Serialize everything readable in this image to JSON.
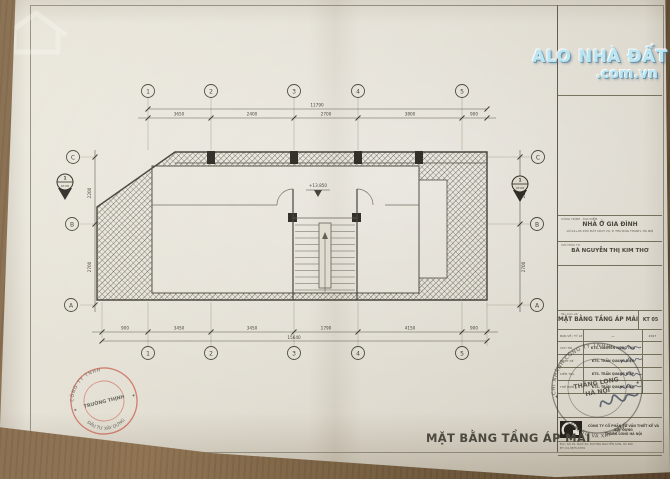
{
  "watermark": {
    "brand": "ALO NHÀ ĐẤT",
    "domain": ".com.vn"
  },
  "drawing_title": "MẶT BẰNG TẦNG ÁP MÁI",
  "colors": {
    "watermark": "#b9e4f2",
    "stamp_red": "#c43426",
    "paper": "#e9e6dc"
  },
  "plan": {
    "level": "+13.850",
    "grid_top": [
      "1",
      "2",
      "3",
      "4",
      "5"
    ],
    "grid_bottom": [
      "1",
      "2",
      "3",
      "4",
      "5"
    ],
    "grid_left": [
      "C",
      "B",
      "A"
    ],
    "grid_right": [
      "C",
      "B",
      "A"
    ],
    "section_left": {
      "num": "1",
      "ref": "KT.08"
    },
    "section_right": {
      "num": "1",
      "ref": "KT.08"
    },
    "dims_top": [
      "3650",
      "2400",
      "2700",
      "3800",
      "900"
    ],
    "dims_top_total": "11790",
    "dims_bottom": [
      "900",
      "3450",
      "3450",
      "1790",
      "4150",
      "900"
    ],
    "dims_bottom_total": "15640",
    "dims_left": [
      "2200",
      "2700"
    ],
    "dims_right": [
      "2200",
      "2700"
    ]
  },
  "titleblock": {
    "project_label": "CÔNG TRÌNH - ĐỊA ĐIỂM",
    "project_name": "NHÀ Ở GIA ĐÌNH",
    "project_address": "LÔ 04+05 KHU ĐẤT DỊCH VỤ, P. THƯỢNG THANH, HÀ NỘI",
    "client_label": "CHỦ ĐẦU TƯ",
    "client_name": "BÀ NGUYỄN THỊ KIM THƠ",
    "drawing_name_label": "Tên bản vẽ:",
    "drawing_name": "MẶT BẰNG TẦNG ÁP MÁI",
    "drawing_no": "KT 05",
    "scale_label": "BẢN VẼ / TỶ LỆ",
    "scale_value": "—",
    "year": "2017",
    "rows": [
      {
        "label": "CHỦ TRÌ",
        "value": "KTS. NGUYỄN NGỌC THỤ"
      },
      {
        "label": "THIẾT KẾ",
        "value": "KTS. TRẦN QUANG ĐIỆP"
      },
      {
        "label": "KIỂM TRA",
        "value": "KTS. TRẦN QUANG ĐIỆP"
      },
      {
        "label": "THỂ HIỆN",
        "value": "KTS. TRẦN QUANG ĐIỆP"
      }
    ],
    "company_line1": "CÔNG TY CỔ PHẦN TƯ VẤN THIẾT KẾ VÀ XÂY DỰNG",
    "company_line2": "THĂNG LONG HÀ NỘI",
    "company_note1": "Đ/C: SỐ 25, NGÕ 92, ĐƯỜNG NGUYỄN SƠN, HÀ NỘI",
    "company_note2": "ĐT: 04.3875.6789"
  },
  "stamps": {
    "red": {
      "ring_top": "CÔNG TY TNHH",
      "ring_bottom": "ĐẦU TƯ XÂY DỰNG",
      "center": "TRƯỜNG THỊNH"
    },
    "black": {
      "ring_top": "CHI NHÁNH CÔNG TY TNHH",
      "ring_bottom": "ĐẦU TƯ VÀ XÂY DỰNG",
      "center1": "THĂNG LONG",
      "center2": "HÀ NỘI"
    }
  }
}
